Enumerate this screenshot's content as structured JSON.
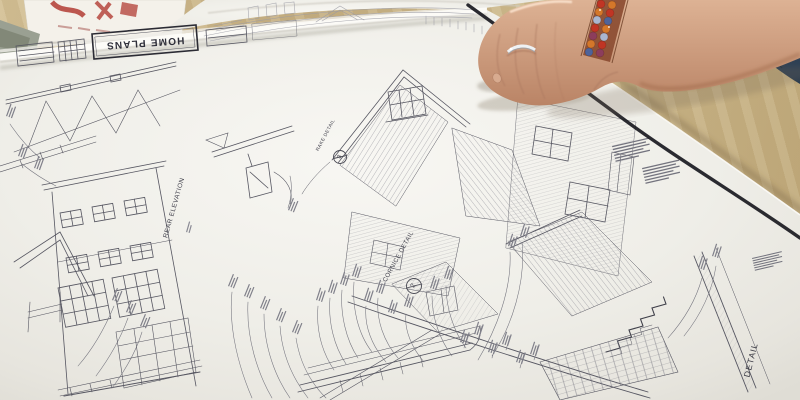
{
  "scene": {
    "description": "Architectural house blueprints unrolled on a wooden table; a hand with a ring and beaded bracelet holds down the curling top edge of the sheet",
    "sheet_logo": "HOME PLANS",
    "labels": {
      "rear_elevation": "REAR ELEVATION",
      "rake_detail": "RAKE DETAIL",
      "rake_detail_number": "3",
      "cornice_detail": "CORNICE DETAIL",
      "cornice_detail_number": "2",
      "wall_detail": "DETAIL"
    },
    "colors": {
      "table_wood": "#c8b289",
      "paper": "#f1f0eb",
      "ink": "#53535d",
      "border_ink": "#1c1c22",
      "skin": "#c99a7c",
      "denim": "#35485e",
      "bracelet_red": "#c03524",
      "bracelet_orange": "#d4772a",
      "red_print": "#b23c34",
      "ring_silver": "#eef1f3"
    }
  }
}
